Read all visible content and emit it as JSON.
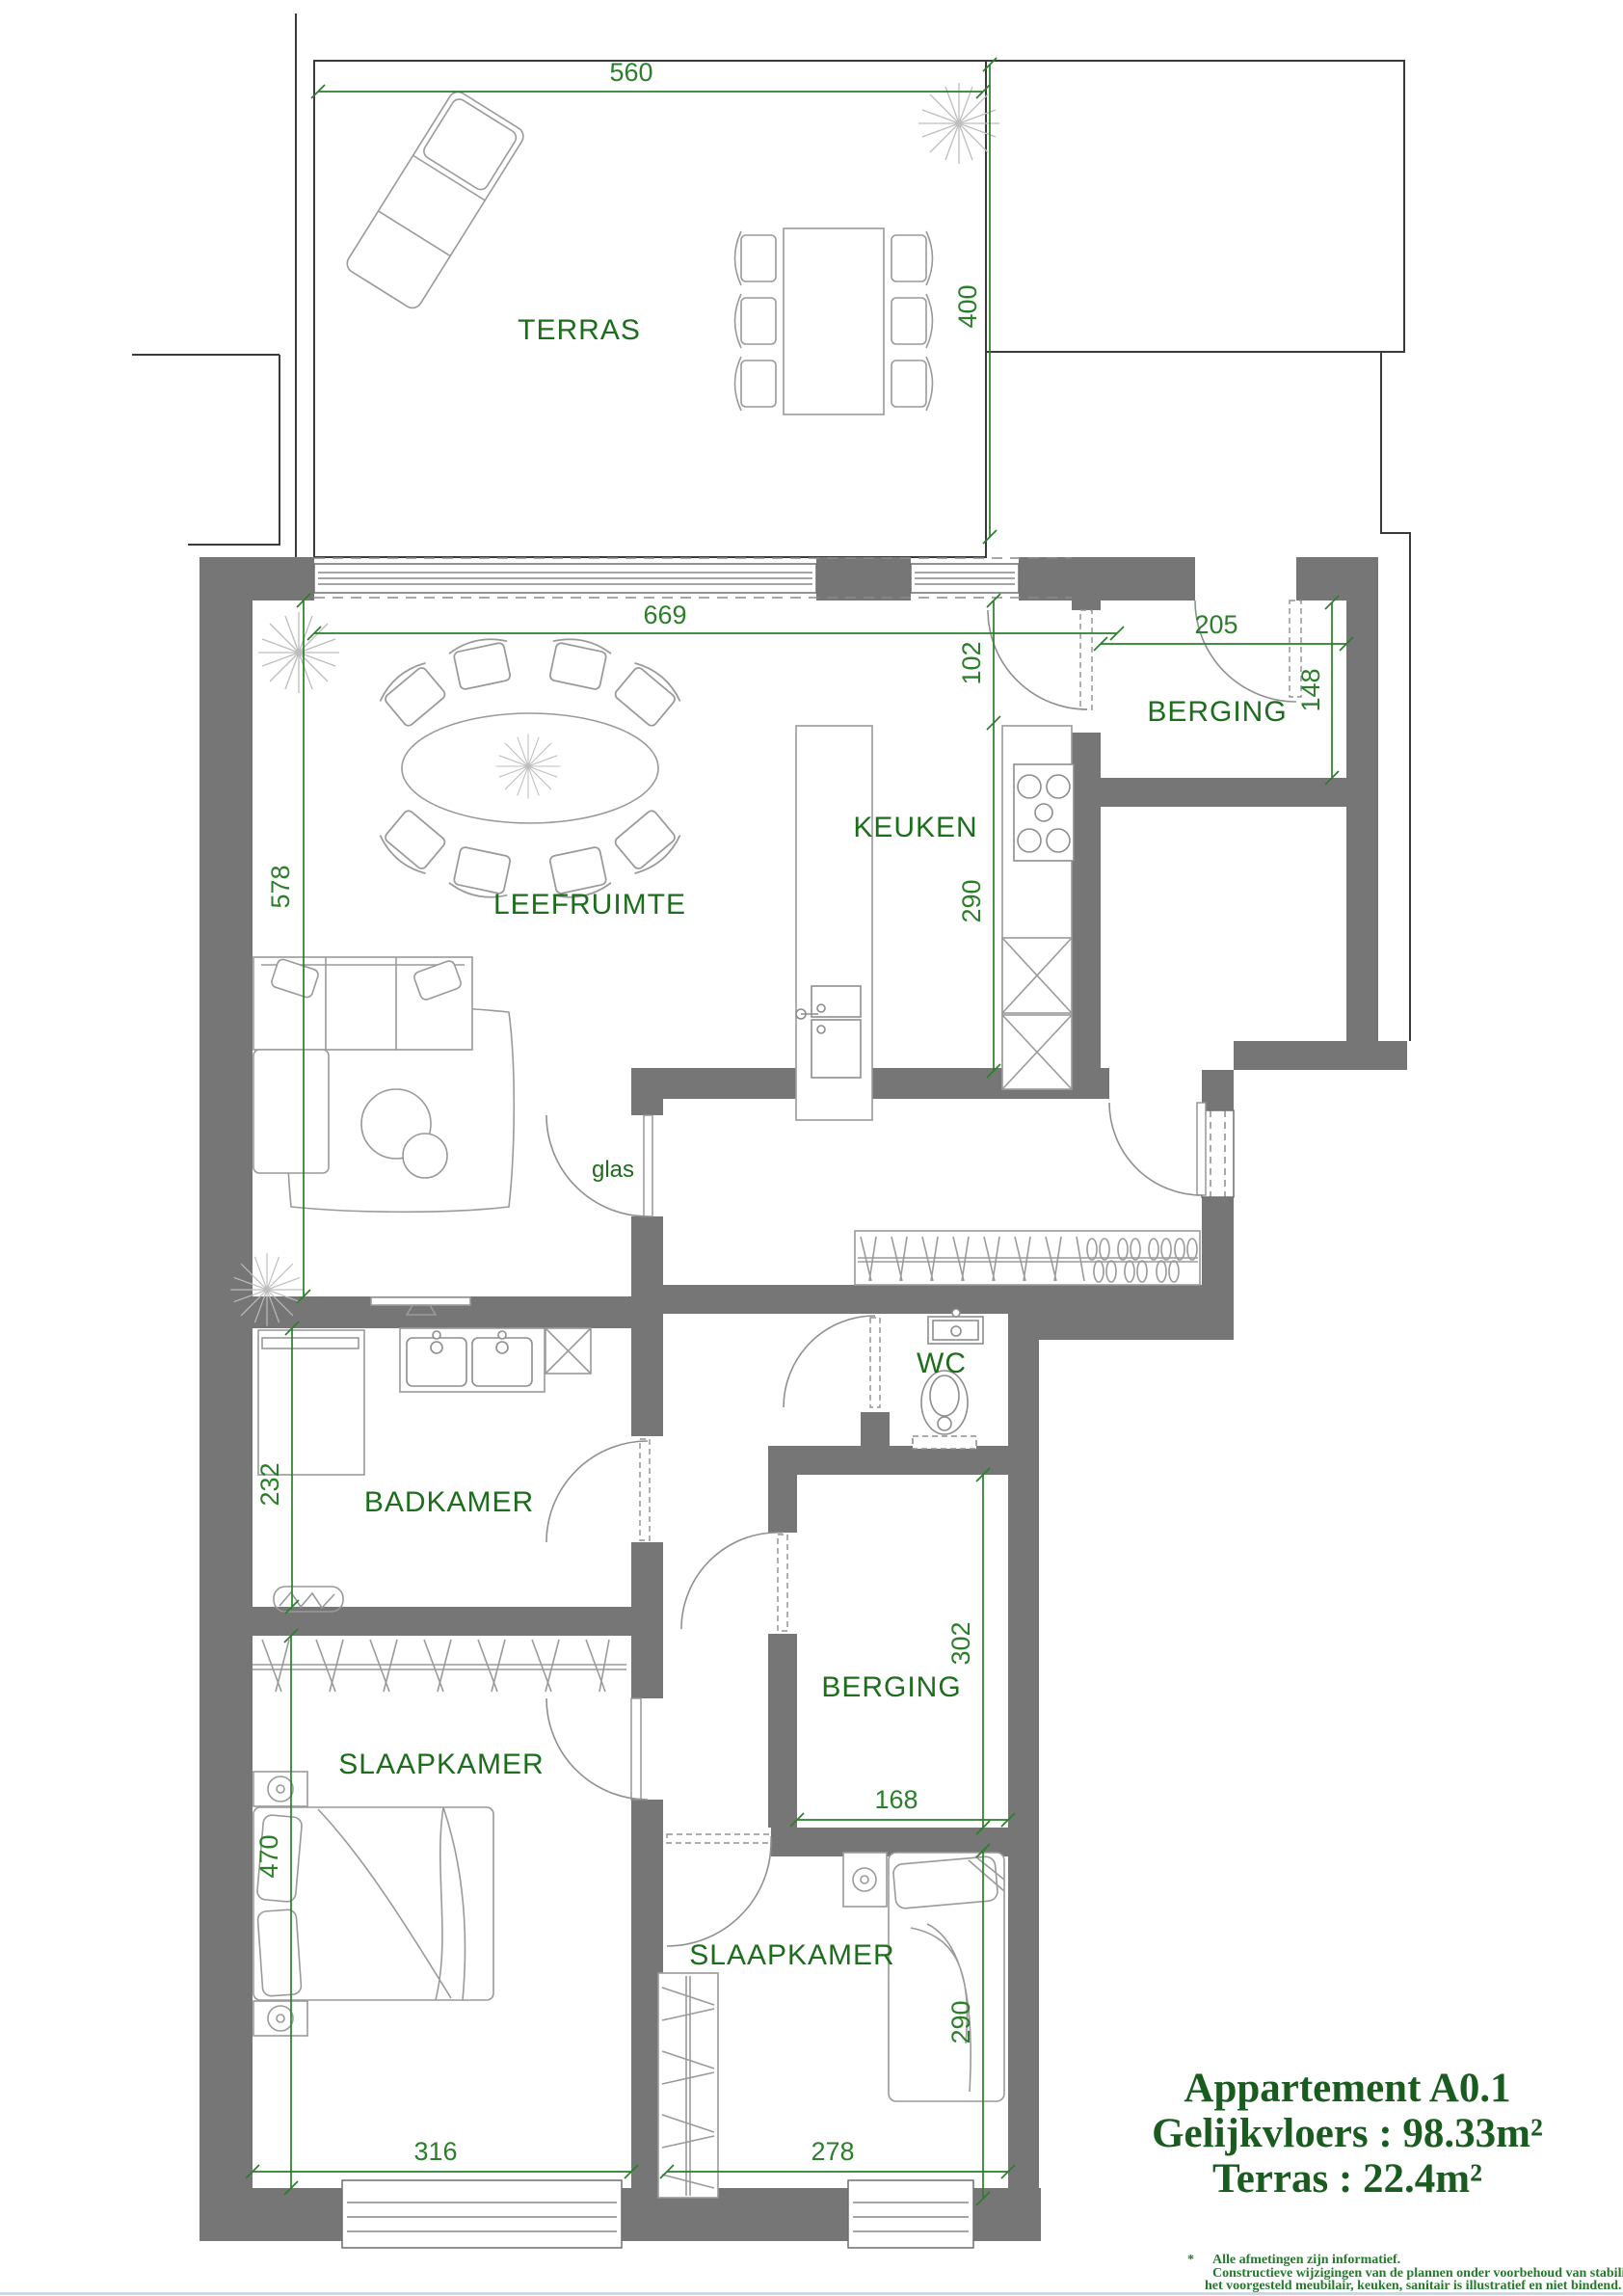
{
  "title_block": {
    "line1": "Appartement A0.1",
    "line2": "Gelijkvloers : 98.33m²",
    "line3": "Terras : 22.4m²"
  },
  "footnote": {
    "bullet": "*",
    "line1": "Alle afmetingen zijn informatief.",
    "line2": "Constructieve wijzigingen van de plannen onder voorbehoud van stabiliteit en technieken.",
    "line3": "het voorgesteld meubilair, keuken, sanitair is illustratief en niet bindend."
  },
  "room_labels": {
    "terras": "TERRAS",
    "leefruimte": "LEEFRUIMTE",
    "keuken": "KEUKEN",
    "berging_top": "BERGING",
    "wc": "WC",
    "badkamer": "BADKAMER",
    "berging": "BERGING",
    "slaapkamer_1": "SLAAPKAMER",
    "slaapkamer_2": "SLAAPKAMER",
    "glas_door": "glas"
  },
  "dimensions_cm": {
    "terras_width": "560",
    "terras_depth": "400",
    "leefruimte_width": "669",
    "leefruimte_depth": "578",
    "keuken_door": "102",
    "keuken_depth": "290",
    "berging_top_width": "205",
    "berging_top_depth": "148",
    "badkamer_depth": "232",
    "berging_depth": "302",
    "berging_width": "168",
    "slaapkamer_1_depth": "470",
    "slaapkamer_1_width": "316",
    "slaapkamer_2_width": "278",
    "slaapkamer_2_depth": "290"
  },
  "colors": {
    "wall_fill": "#767676",
    "dimension_green": "#2b7f2b",
    "label_green": "#1c6e1c",
    "title_green": "#1a5c20",
    "outline_dark": "#3a3a3a",
    "furniture_gray": "#9a9a9a",
    "footer_rule": "#ccd9e2"
  }
}
